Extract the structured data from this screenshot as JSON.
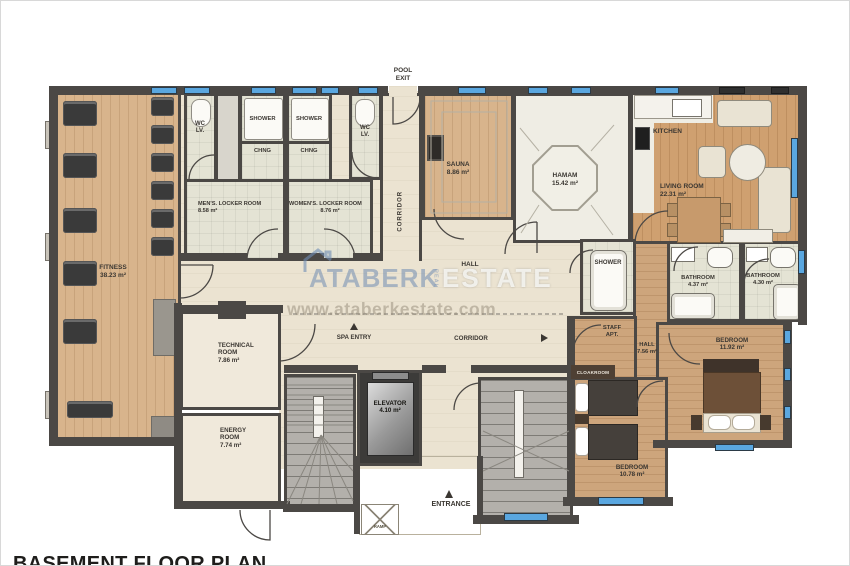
{
  "meta": {
    "title": "BASEMENT FLOOR PLAN"
  },
  "watermark": {
    "brand_left": "ATABERK",
    "brand_mid": "REAL",
    "brand_right": "ESTATE",
    "url": "www.ataberkestate.com"
  },
  "nav": {
    "pool_exit_1": "POOL",
    "pool_exit_2": "EXIT",
    "spa_entry": "SPA ENTRY",
    "entrance": "ENTRANCE",
    "corridor": "CORRIDOR",
    "hall": "HALL",
    "cloakroom": "CLOAKROOM",
    "ramp": "RAMP",
    "staff_1": "STAFF",
    "staff_2": "APT."
  },
  "rooms": {
    "fitness": {
      "name": "FITNESS",
      "area": "38.23 m²"
    },
    "wc": {
      "name": "WC",
      "sub": "LV."
    },
    "shower": {
      "name": "SHOWER"
    },
    "chng": {
      "name": "CHNG"
    },
    "mens_locker": {
      "name": "MEN'S. LOCKER ROOM",
      "area": "8.58 m²"
    },
    "womens_locker": {
      "name": "WOMEN'S. LOCKER ROOM",
      "area": "8.76 m²"
    },
    "sauna": {
      "name": "SAUNA",
      "area": "8.86 m²"
    },
    "hamam": {
      "name": "HAMAM",
      "area": "15.42 m²"
    },
    "kitchen": {
      "name": "KITCHEN"
    },
    "living": {
      "name": "LIVING ROOM",
      "area": "22.31 m²"
    },
    "bathroom_1": {
      "name": "BATHROOM",
      "area": "4.37 m²"
    },
    "bathroom_2": {
      "name": "BATHROOM",
      "area": "4.30 m²"
    },
    "technical": {
      "name_1": "TECHNICAL",
      "name_2": "ROOM",
      "area": "7.86 m²"
    },
    "energy": {
      "name_1": "ENERGY",
      "name_2": "ROOM",
      "area": "7.74 m²"
    },
    "elevator": {
      "name": "ELEVATOR",
      "area": "4.10 m²"
    },
    "staff_hall": {
      "name": "HALL",
      "area": "7.56 m²"
    },
    "bedroom_1": {
      "name": "BEDROOM",
      "area": "11.92 m²"
    },
    "bedroom_2": {
      "name": "BEDROOM",
      "area": "10.78 m²"
    }
  },
  "colors": {
    "wall": "#4b4845",
    "window_blue": "#5aa7e0",
    "wood": "#d8b48c",
    "hall_floor": "#ebe3d1",
    "stairs": "#b3b0ab",
    "watermark_blue": "#7891b4"
  }
}
